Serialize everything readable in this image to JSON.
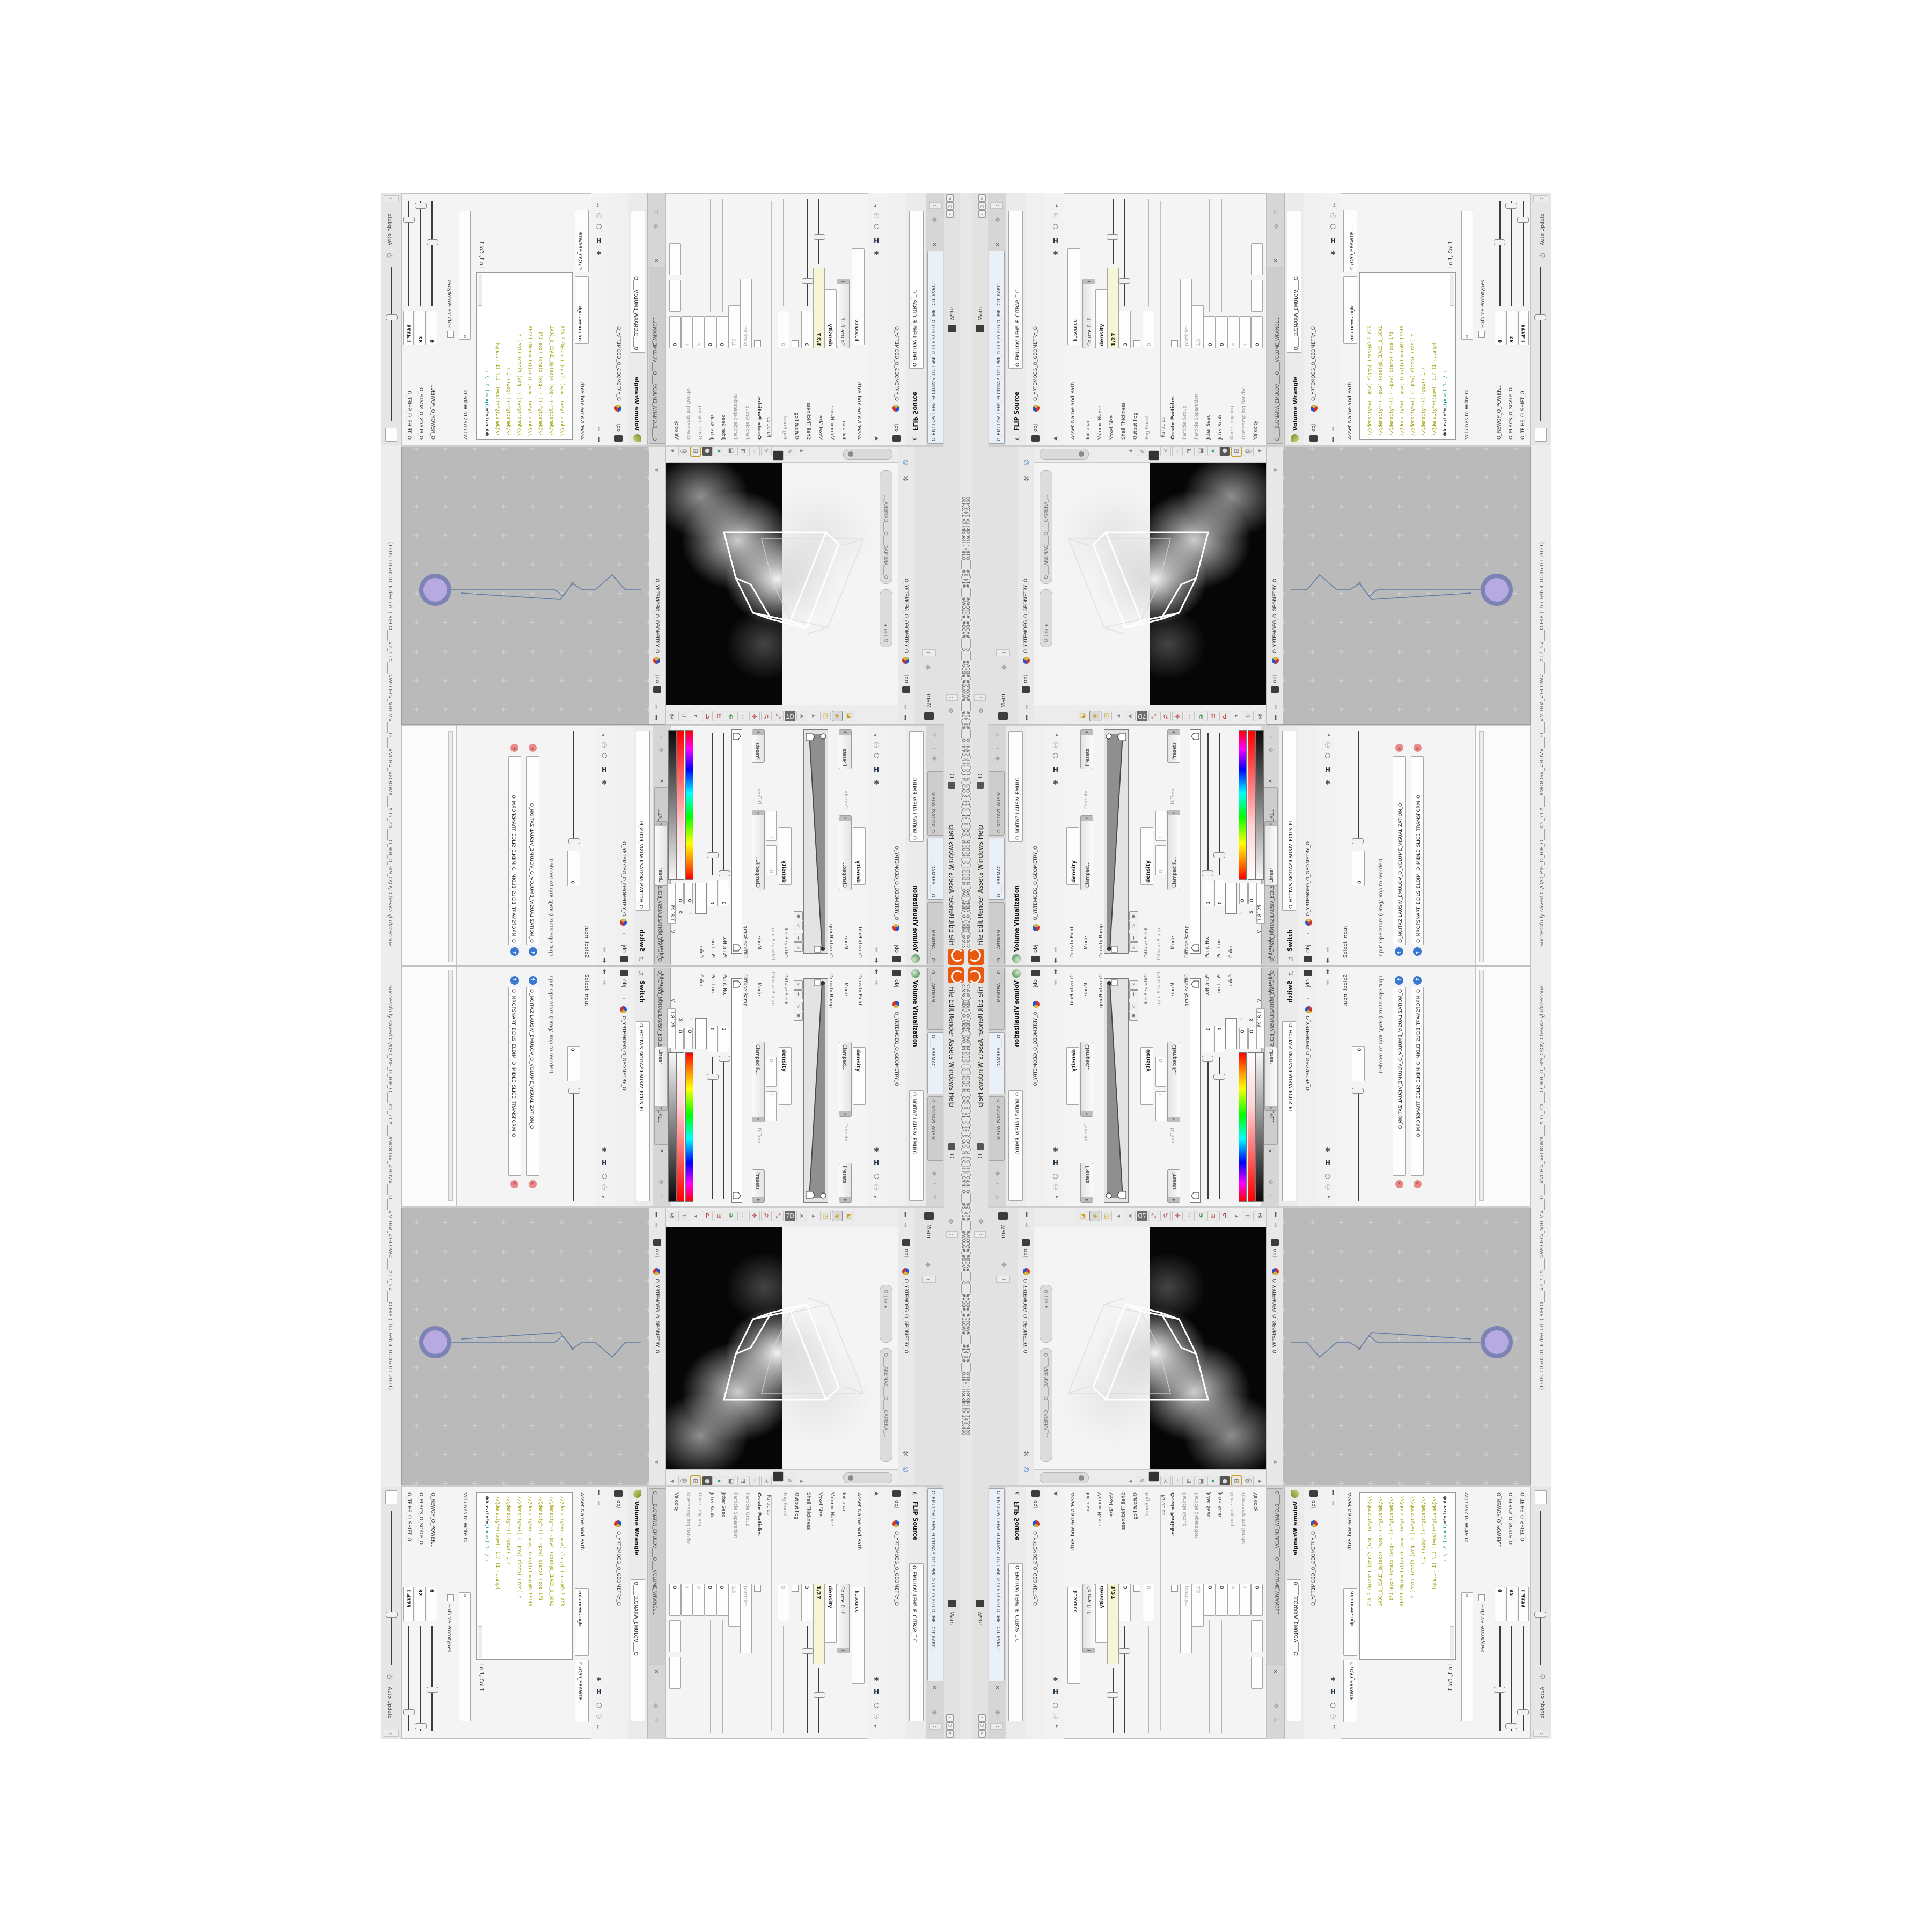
{
  "window": {
    "title": "c:/o/o_AIDIV_O_VIDIA_O/O_INIDUOH_O_HOUDINI_O/O_5_71_O_17_5_O/O_PIH_O_HIP_O/PIH.O____#5_71#____#WOLG#_#BDV#____O____#VDB#_#GLOW#____#17_5#____O.HIP - Houdini FX 17.5.460",
    "status": "Successfully saved C:/O/O_PIH_O_HIP_O____#5_71#____#WOLG#_#BDV#____O____#VDB#_#GLOW#____#17_5#____O.HIP (Thu Feb 4 10:46:01 2021)",
    "menu": "File    Edit    Render    Assets    Windows    Help",
    "menu_right": "O",
    "main_tab": "Main",
    "auto_update": "Auto Update",
    "buttons": {
      "min": "–",
      "max": "▢",
      "close": "✕"
    }
  },
  "breadcrumb": {
    "obj": "obj",
    "sep": "›",
    "geo_path": "O_YRTEMOEG_O_GEOMETRY_O"
  },
  "viz": {
    "tab_mantra": "O____ARTNAM_...",
    "tab_camera": "O____AREMAC_...",
    "tab_viz": "O_NOITAZILAUSIV...",
    "title": "Volume Visualization",
    "name": "O_NOITAZILAUSIV_EMULO",
    "density_field_label": "Density Field",
    "density_field_value": "density",
    "mode_label": "Mode",
    "mode_value": "Clamped...",
    "density_label": "Density",
    "presets": "Presets",
    "density_ramp_label": "Density Ramp",
    "diffuse_field_label": "Diffuse Field",
    "diffuse_field_value": "density",
    "diffuse_range_label": "Diffuse Range",
    "diffuse_range_min": "0",
    "diffuse_range_max": "1",
    "mode2_value": "Clamped R...",
    "diffuse_label": "Diffuse",
    "diffuse_ramp_label": "Diffuse Ramp",
    "point_no_label": "Point No.",
    "point_no_value": "1",
    "position_label": "Position",
    "position_value": "0",
    "color_label": "Color",
    "h_label": "H",
    "h_value": "0",
    "s_label": "S",
    "s_value": "0",
    "v_label": "V",
    "v_value": "1.8125",
    "interp_label": "Interpolation",
    "interp_value": "Linear"
  },
  "switch": {
    "tab": "O_HCTIWS_NOITAZILAUSIV_ECILS_ELDIM_O_MIDLE_SLICE_VISUAL...",
    "title": "Switch",
    "name": "O_HCTIWS_NOITAZILAUSIV_ECILS_EL",
    "select_input_label": "Select Input",
    "select_input_value": "0",
    "list_header": "Input Operators (Drag/Drop to reorder)",
    "item1": "O_NOITAZILAUSIV_EMULOV_O_VOLUME_VISUALIZATION_O",
    "item2": "O_MROFSNART_ECILS_ELDIM_O_MIDLE_SLICE_TRANSFORM_O"
  },
  "flip": {
    "tab": "O_EMULOV_LEH5_ELCITRAP_TICILPMI_DIULF_O_FLUID_IMPLICIT_PARTI...",
    "title": "FLIP Source",
    "name": "O_EMULOV_LEH5_ELCITRAP_TICI",
    "asset_label": "Asset Name and Path",
    "asset_value": "flipsource",
    "params": [
      {
        "label": "Initialize",
        "value": "Source FLIP",
        "kind": "btn"
      },
      {
        "label": "Volume Name",
        "value": "density",
        "kind": "bold"
      },
      {
        "label": "Voxel Size",
        "value": "1/27",
        "kind": "yel"
      },
      {
        "label": "Shell Thickness",
        "value": "3",
        "kind": "fld"
      },
      {
        "label": "Output Fog",
        "value": "",
        "kind": "cb"
      },
      {
        "label": "Fog Boost",
        "value": "0",
        "kind": "gry"
      },
      {
        "label": "Particles",
        "value": "",
        "kind": "sep"
      },
      {
        "label": "Create Particles",
        "value": "",
        "kind": "cb"
      },
      {
        "label": "Particle Group",
        "value": "particles",
        "kind": "gry"
      },
      {
        "label": "Particle Separation",
        "value": "1/9",
        "kind": "gry"
      },
      {
        "label": "Jitter Seed",
        "value": "0",
        "kind": "fld"
      },
      {
        "label": "Jitter Scale",
        "value": "0",
        "kind": "fld"
      },
      {
        "label": "Oversampling",
        "value": "2",
        "kind": "gry"
      },
      {
        "label": "Oversampling Bandwi...",
        "value": "1",
        "kind": "gry"
      },
      {
        "label": "Velocity",
        "value": "0",
        "kind": "fld"
      },
      {
        "label": "Add Rest Attribute",
        "value": "",
        "kind": "cb"
      }
    ]
  },
  "wrangle": {
    "tab": "O____ELGNARW_EMULOV____O____VOLUME_WRANGL...",
    "title": "Volume Wrangle",
    "name": "O____ELGNARW_EMULOV____O",
    "asset_label": "Asset Name and Path",
    "asset_value": "volumewrangle",
    "asset_value2": "C:/O/O_ERAWTF...",
    "code": [
      "//@density*=(  -pow(  clamp(  (cos(@O_ELACS_",
      "//@density*=(  -pow(  (cos(@O_ELACS_O_SCAL",
      "//@density*=(( (  -pow(  clamp(  (cos(1*$",
      "//@density*=(  -pow(  (cos((clamp(@O_TFIHS",
      "//@density*=(( (  -pow(  clamp(  (cos( c",
      "//@density*=((     (pow((       1./",
      "//@density*=((pow((    1./ (1.-clamp(",
      "((pow((    1. / ("
    ],
    "active_prefix": "@density*=",
    "volumes_label": "Volumes to Write to",
    "volumes_value": "*",
    "enforce_label": "Enforce Prototypes",
    "cursor_label": "Ln 1, Col 1",
    "spare": [
      {
        "label": "O_REWOP_O_POWER...",
        "value": "6"
      },
      {
        "label": "O_ELACS_O_SCALE_O",
        "value": "32"
      },
      {
        "label": "O_TFIHS_O_SHIFT_O",
        "value": "1.4375"
      }
    ]
  },
  "viewport": {
    "pill_ortho": "Ortho ▾",
    "pill_camera": "O____AREMAC____O____CAMERA_...",
    "obj": "obj"
  },
  "network": {
    "watermark": "Geometry",
    "path": "O_YRTEMOEG_O_GEOMETRY_O",
    "nodes": [
      {
        "label": "Transform",
        "name": "O_MROFSNART_TLUSER_O_RESULT_TRANSFORM_O"
      },
      {
        "label": "Merge",
        "name": "O_ECAFRUS_HTIW_EMULOV_EGREM_O_MERGE_VOLUME_WITH_SURFACE_O"
      },
      {
        "label": "Switch",
        "name": "O_HCTIWS_NOITAZILAUSIV_ECILS_ELDIM_O_MIDLE_SLICE_VIS..."
      },
      {
        "label": "Transform",
        "name": "O_MROFSNART_ECILS_ELDIM_O_MIDLE_SLICE_TRANSFOR..."
      },
      {
        "label": "Volume Visualiza",
        "name": "O_NOITAZILAUSIV_EMULOV_O_VOLUME_VISUALIZATION_O"
      },
      {
        "label": "Volume Wrangle",
        "name": "O____ELGNARW_EMULOV____O____VOLUME_WRANGLE..."
      },
      {
        "label": "VDB from Polygons",
        "name": "O_SNOGYLOP_YRTEMOEG_MORF_EMULOV_BDV_O_VDB_VOLUM..."
      },
      {
        "label": "FLIP Source",
        "name": "O_EMULOV_LEH5_ELCITRAP_TICILPMI_DIULF_O_FLUID_IMPLIC..."
      },
      {
        "label": "Clip",
        "name": "O_PMAR_O_RAMP_O"
      },
      {
        "label": "Clip",
        "name": "O_PMAR_O_RAMP_O2"
      },
      {
        "label": "Switch",
        "name": "O_HCTIWS_YRTEMOEG_LANRETXE_LANRETNI_O_INTERNAL_EXTERN..."
      },
      {
        "label": "File",
        "name": "O_JBO.UOS.PETS_O_STEP.SOU.OBJ_O"
      },
      {
        "label": "PolyWire",
        "name": "O_EMARFERIW_NOGYLOP_EREHPS_EBUC_O_CUBE_SPHERE_POLYGON_W..."
      },
      {
        "label": "ae_CubeSphere",
        "name": "O_EREHPS_EBUC_O_CUBE_SPHERE_O"
      }
    ]
  }
}
